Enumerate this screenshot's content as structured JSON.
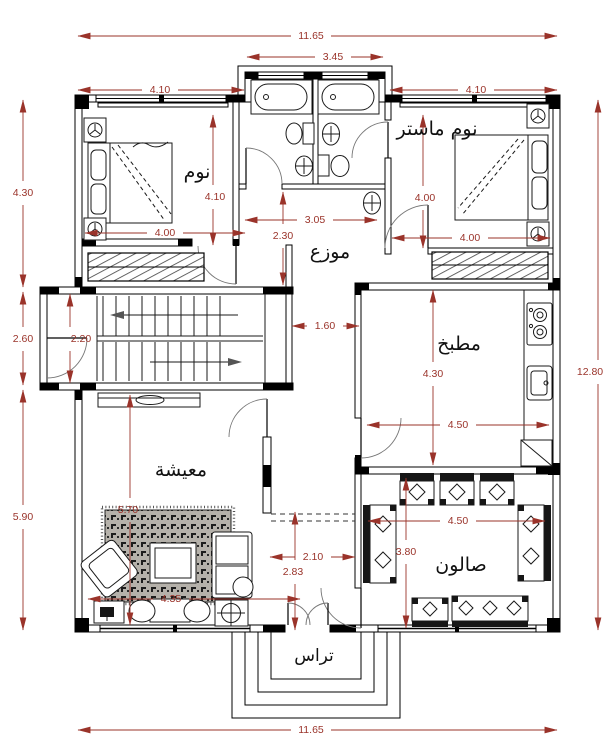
{
  "colors": {
    "dim": "#9a332a",
    "wall": "#000000",
    "furniture": "#1a1a1a",
    "rug": "#b5b1aa"
  },
  "rooms": {
    "bedroom": "نوم",
    "master_bedroom": "نوم ماستر",
    "hall": "موزع",
    "kitchen": "مطبخ",
    "living": "معيشة",
    "salon": "صالون",
    "terrace": "تراس"
  },
  "dims": {
    "top_total": "11.65",
    "top_bath": "3.45",
    "top_left_room": "4.10",
    "top_right_room": "4.10",
    "left_upper": "4.30",
    "left_stair": "2.60",
    "left_lower": "5.90",
    "right_total": "12.80",
    "bottom_total": "11.65",
    "bedroom_depth": "4.10",
    "bedroom_width": "4.00",
    "master_depth": "4.00",
    "master_width": "4.00",
    "hall_width": "3.05",
    "hall_depth": "2.30",
    "stair_width": "2.20",
    "corridor": "1.60",
    "kitchen_depth": "4.30",
    "kitchen_width": "4.50",
    "living_depth": "5.70",
    "living_width": "4.35",
    "entry_width": "2.10",
    "entry_depth": "2.83",
    "salon_width": "4.50",
    "salon_depth": "3.80"
  }
}
